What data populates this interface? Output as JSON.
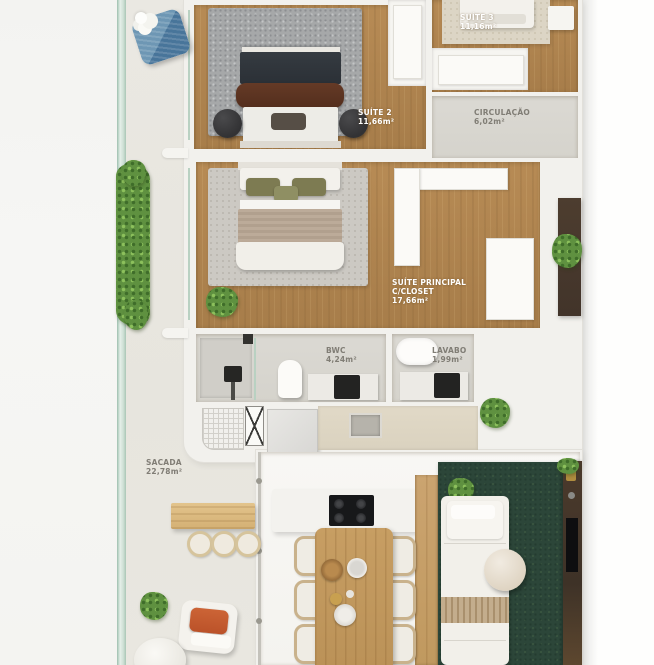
{
  "plan_type": "apartment-floor-plan",
  "rooms": {
    "suite2": {
      "name": "SUÍTE 2",
      "area": "11,66m²"
    },
    "suite3": {
      "name": "SUÍTE 3",
      "area": "11,16m²"
    },
    "circulacao": {
      "name": "CIRCULAÇÃO",
      "area": "6,02m²"
    },
    "suite_principal": {
      "name": "SUÍTE PRINCIPAL",
      "closet": "C/CLOSET",
      "area": "17,66m²"
    },
    "bwc": {
      "name": "BWC",
      "area": "4,24m²"
    },
    "lavabo": {
      "name": "LAVABO",
      "area": "1,99m²"
    },
    "sacada": {
      "name": "SACADA",
      "area": "22,78m²"
    }
  },
  "colors": {
    "wood_floor": "#ad8552",
    "wall": "#f2f1ed",
    "gray_floor": "#d9d7d1",
    "rug_gray": "#a6a8a9",
    "rug_master": "#ccc9c3",
    "rug_beige": "#dcd5c5",
    "living_rug_green": "#2c4639",
    "hedge_green": "#5f9140",
    "accent_orange": "#c2572c",
    "accent_blue": "#5c88a7",
    "tv_panel_brown": "#453528",
    "bed_dark_blanket": "#30353b",
    "bed_brown_throw": "#5d3522",
    "pillow_olive": "#7d7b52"
  }
}
